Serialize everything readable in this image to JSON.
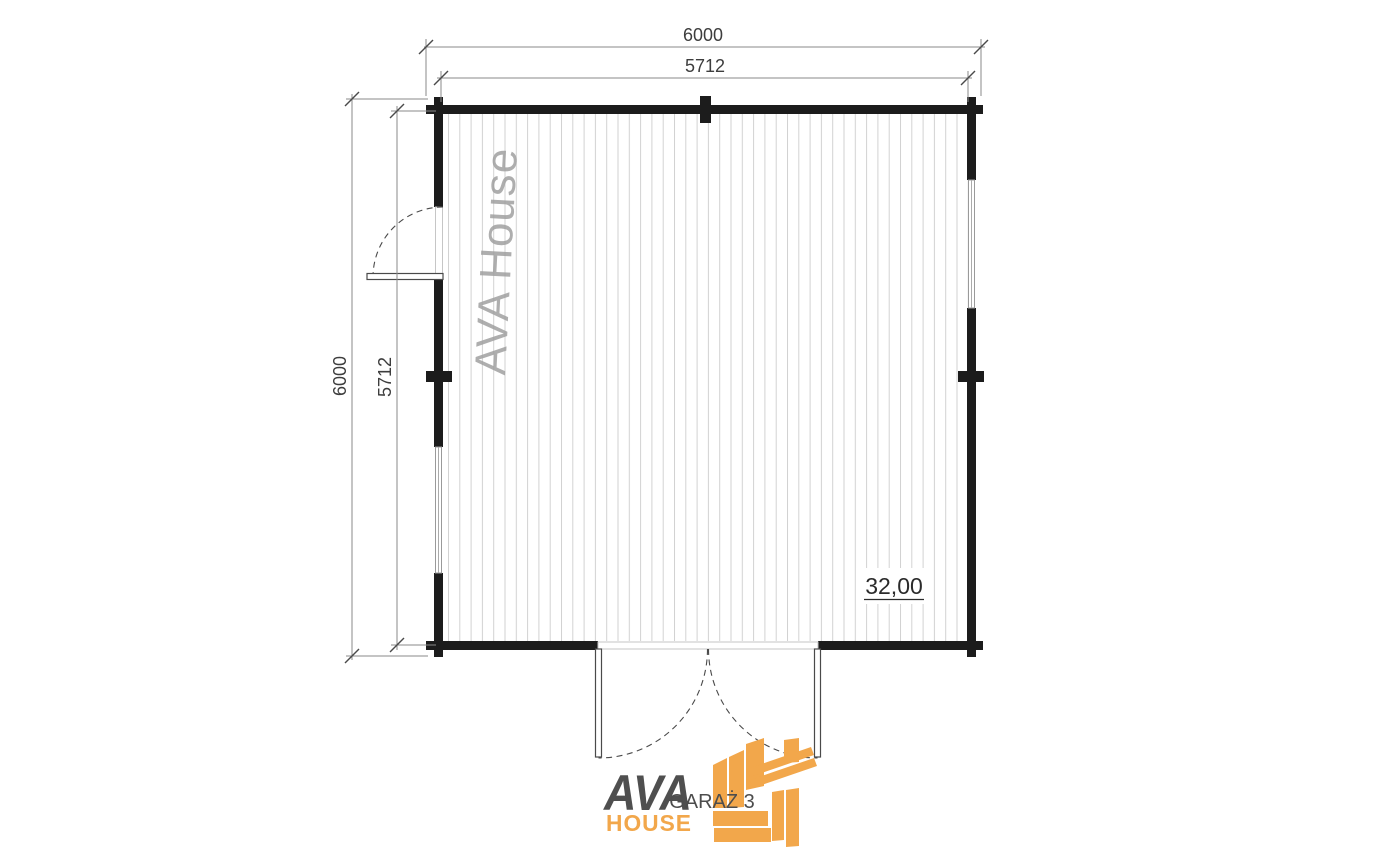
{
  "plan": {
    "dimensions": {
      "top_outer": "6000",
      "top_inner": "5712",
      "left_outer": "6000",
      "left_inner": "5712"
    },
    "area_label": "32,00",
    "drawing_title": "GARAŻ 3",
    "watermark": "AVA House"
  },
  "logo": {
    "name": "AVA",
    "subname": "HOUSE"
  },
  "colors": {
    "wall": "#1c1c1c",
    "hatch_line": "#d2d2d2",
    "dim_line": "#8a8a8a",
    "dim_text": "#3d3d3d",
    "watermark_text": "#a0a0a0",
    "door_line": "#4a4a4a",
    "frame_line": "#c6c6c6",
    "logo_gray": "#4f4f4f",
    "logo_orange": "#f2a74b",
    "page_bg": "#ffffff"
  }
}
